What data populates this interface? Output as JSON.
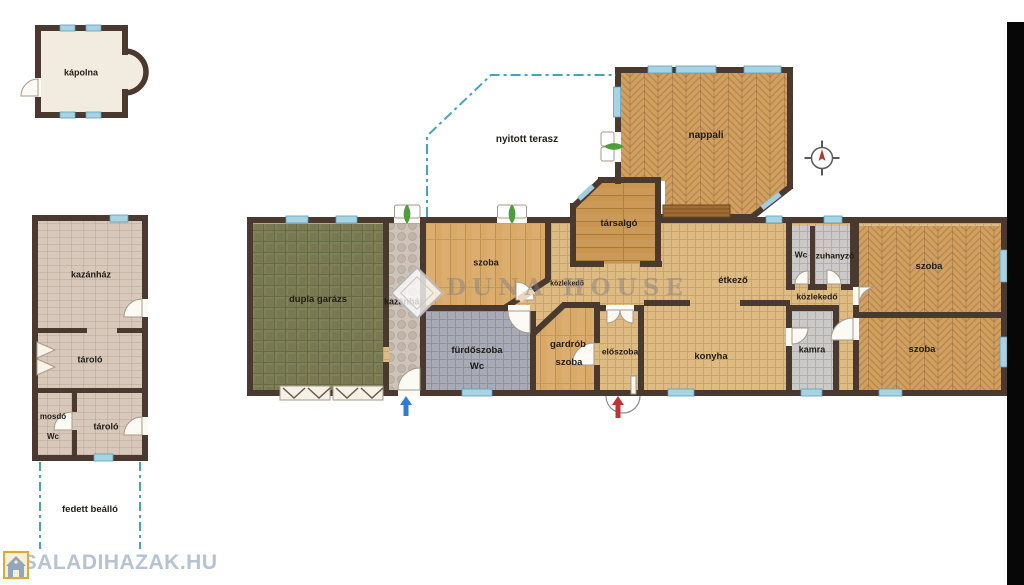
{
  "watermark": {
    "text": "DUNA HOUSE"
  },
  "footer": {
    "site": "CSALADIHAZAK.HU"
  },
  "colors": {
    "wall": "#4a392e",
    "window": "#a7d4e4",
    "terrace_dash": "#3fa7bc",
    "entry_arrow_red": "#bf3430",
    "entry_arrow_blue": "#2e7fd0"
  },
  "rooms": {
    "kapolna": {
      "label": "kápolna"
    },
    "kazanhaz_outbuilding": {
      "label": "kazánház"
    },
    "tarolo_upper": {
      "label": "tároló"
    },
    "mosdo": {
      "label": "mosdó"
    },
    "mosdo_wc": {
      "label": "Wc"
    },
    "tarolo_lower": {
      "label": "tároló"
    },
    "fedett_beallo": {
      "label": "fedett beálló"
    },
    "dupla_garazs": {
      "label": "dupla garázs"
    },
    "kazanhaz_main": {
      "label": "kazánház"
    },
    "szoba_left": {
      "label": "szoba"
    },
    "kozlekedo_left": {
      "label": "közlekedő"
    },
    "tarsalgo": {
      "label": "társalgó"
    },
    "nyitott_terasz": {
      "label": "nyitott terasz"
    },
    "nappali": {
      "label": "nappali"
    },
    "etkezo": {
      "label": "étkező"
    },
    "wc": {
      "label": "Wc"
    },
    "zuhanyzo": {
      "label": "zuhanyzó"
    },
    "kozlekedo_right": {
      "label": "közlekedő"
    },
    "kamra": {
      "label": "kamra"
    },
    "szoba_upper_right": {
      "label": "szoba"
    },
    "szoba_lower_right": {
      "label": "szoba"
    },
    "furdoszoba": {
      "label": "fürdőszoba"
    },
    "furdoszoba_wc": {
      "label": "Wc"
    },
    "gardrob": {
      "label": "gardrób"
    },
    "gardrob_szoba": {
      "label": "szoba"
    },
    "eloszoba": {
      "label": "előszoba"
    },
    "konyha": {
      "label": "konyha"
    }
  }
}
